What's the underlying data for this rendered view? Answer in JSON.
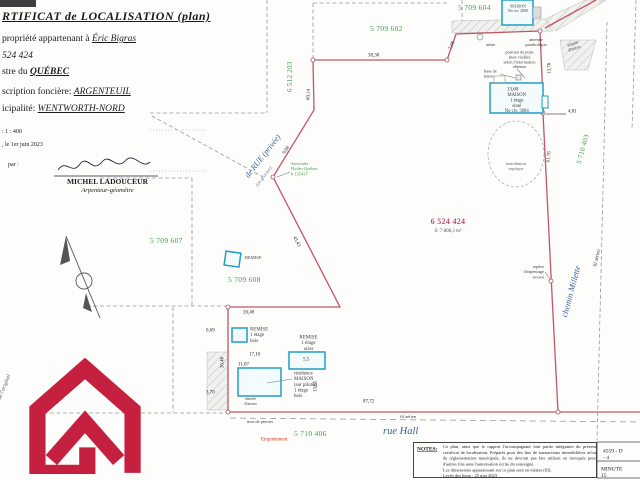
{
  "header": {
    "title": "RTIFICAT de LOCALISATION (plan)",
    "owner_prefix": "propriété appartenant à ",
    "owner_value": "Éric Bigras",
    "lot_value": "524 424",
    "registry_prefix": "stre du ",
    "registry_value": "QUÉBEC",
    "district_prefix": "scription foncière:  ",
    "district_value": "ARGENTEUIL",
    "municipality_prefix": "icipalité: ",
    "municipality_value": "WENTWORTH-NORD",
    "scale": ": 1 : 400",
    "date": ", le 1er juin 2023",
    "par": "par :"
  },
  "signature": {
    "name": "MICHEL LADOUCEUR",
    "role": "Arpenteur-géomètre"
  },
  "lots": {
    "n5709602": "5 709 602",
    "n5709604": "5 709 604",
    "n6512203": "6 512 203",
    "n5709607": "5 709 607",
    "n5709608": "5 709 608",
    "n5710403": "5 710 403",
    "n5710406": "5 710 406"
  },
  "main_lot": {
    "number": "6 524 424",
    "area": "S: 7 808,3 m²"
  },
  "roads": {
    "rue_hall": "rue Hall",
    "chemin_millette": "chemin Millette",
    "rue_privee": "de RUE (privée)",
    "rue_privee_note": "(en gravier)"
  },
  "buildings": {
    "maison2000": "MAISON\nNo civ. 2000",
    "maison3004": "MAISON\n1 étage\nsitué\nNo civ. 3004",
    "remise": "REMISE",
    "remise_bois": "REMISE\n1 étage\nbois",
    "remise_acier": "REMISE\n1 étage\nacier",
    "residence": "résidence\nMAISON\n(sur pilotis)\n1 étage\nbois"
  },
  "annotations": {
    "arbre": "arbre",
    "antenne": "antenne\nparabolique",
    "puits": "position du puits\n(non visible)\nselon l'information\nobtenue",
    "base_beton": "base de\nbéton",
    "entree_autos_ne": "entrée\nd'autos",
    "entree_autos_sw": "entrée\nd'autos",
    "septique": "installation\nseptique",
    "repere": "repère\nd'arpentage\ntrouvé",
    "servitude": "Servitude\nHydro-Québec\n# 135437",
    "fil_aerien_est": "fil aérien",
    "fil_aerien_sud": "fil aérien",
    "mur_pierres": "mur de pierres",
    "empietement": "Empiètement",
    "marginal": "de l'original"
  },
  "dims": {
    "d38_38": "38,38",
    "d7_08": "7,08",
    "d60_14": "60,14",
    "d9_08": "9,08",
    "d43_43": "43,43",
    "d20_48": "20,48",
    "d30_48": "30,48",
    "d87_72": "87,72",
    "d61_76": "61,76",
    "d13_60": "13,60",
    "d4_81": "4,81",
    "d13_76": "13,76",
    "d17_10": "17,10",
    "d11_07": "11,07",
    "d13_65": "13,65",
    "d3_70": "3,70",
    "d0_69": "0,69",
    "d5_5": "5,5"
  },
  "notes": {
    "label": "NOTES:",
    "body": "Ce plan, ainsi que le rapport l'accompagnant font partie intégrante du présent certificat de localisation. Préparés pour des fins de transactions immobilières et/ou de réglementation municipale, ils ne devront pas être utilisés ou invoqués pour d'autres fins sans l'autorisation écrite du soussigné.\nLes dimensions apparaissant sur ce plan sont en mètres (SI).\nLevés des lieux : 25 mai 2023"
  },
  "filecard": {
    "dossier": "4559 - D - 4",
    "minute": "MINUTE 15"
  },
  "colors": {
    "boundary_red": "#c25568",
    "lot_green": "#3c9a50",
    "main_lot_magenta": "#c2497a",
    "building_blue": "#1f9fc4",
    "road_text_blue": "#3a5f9e",
    "logo_crimson": "#c5203f"
  }
}
